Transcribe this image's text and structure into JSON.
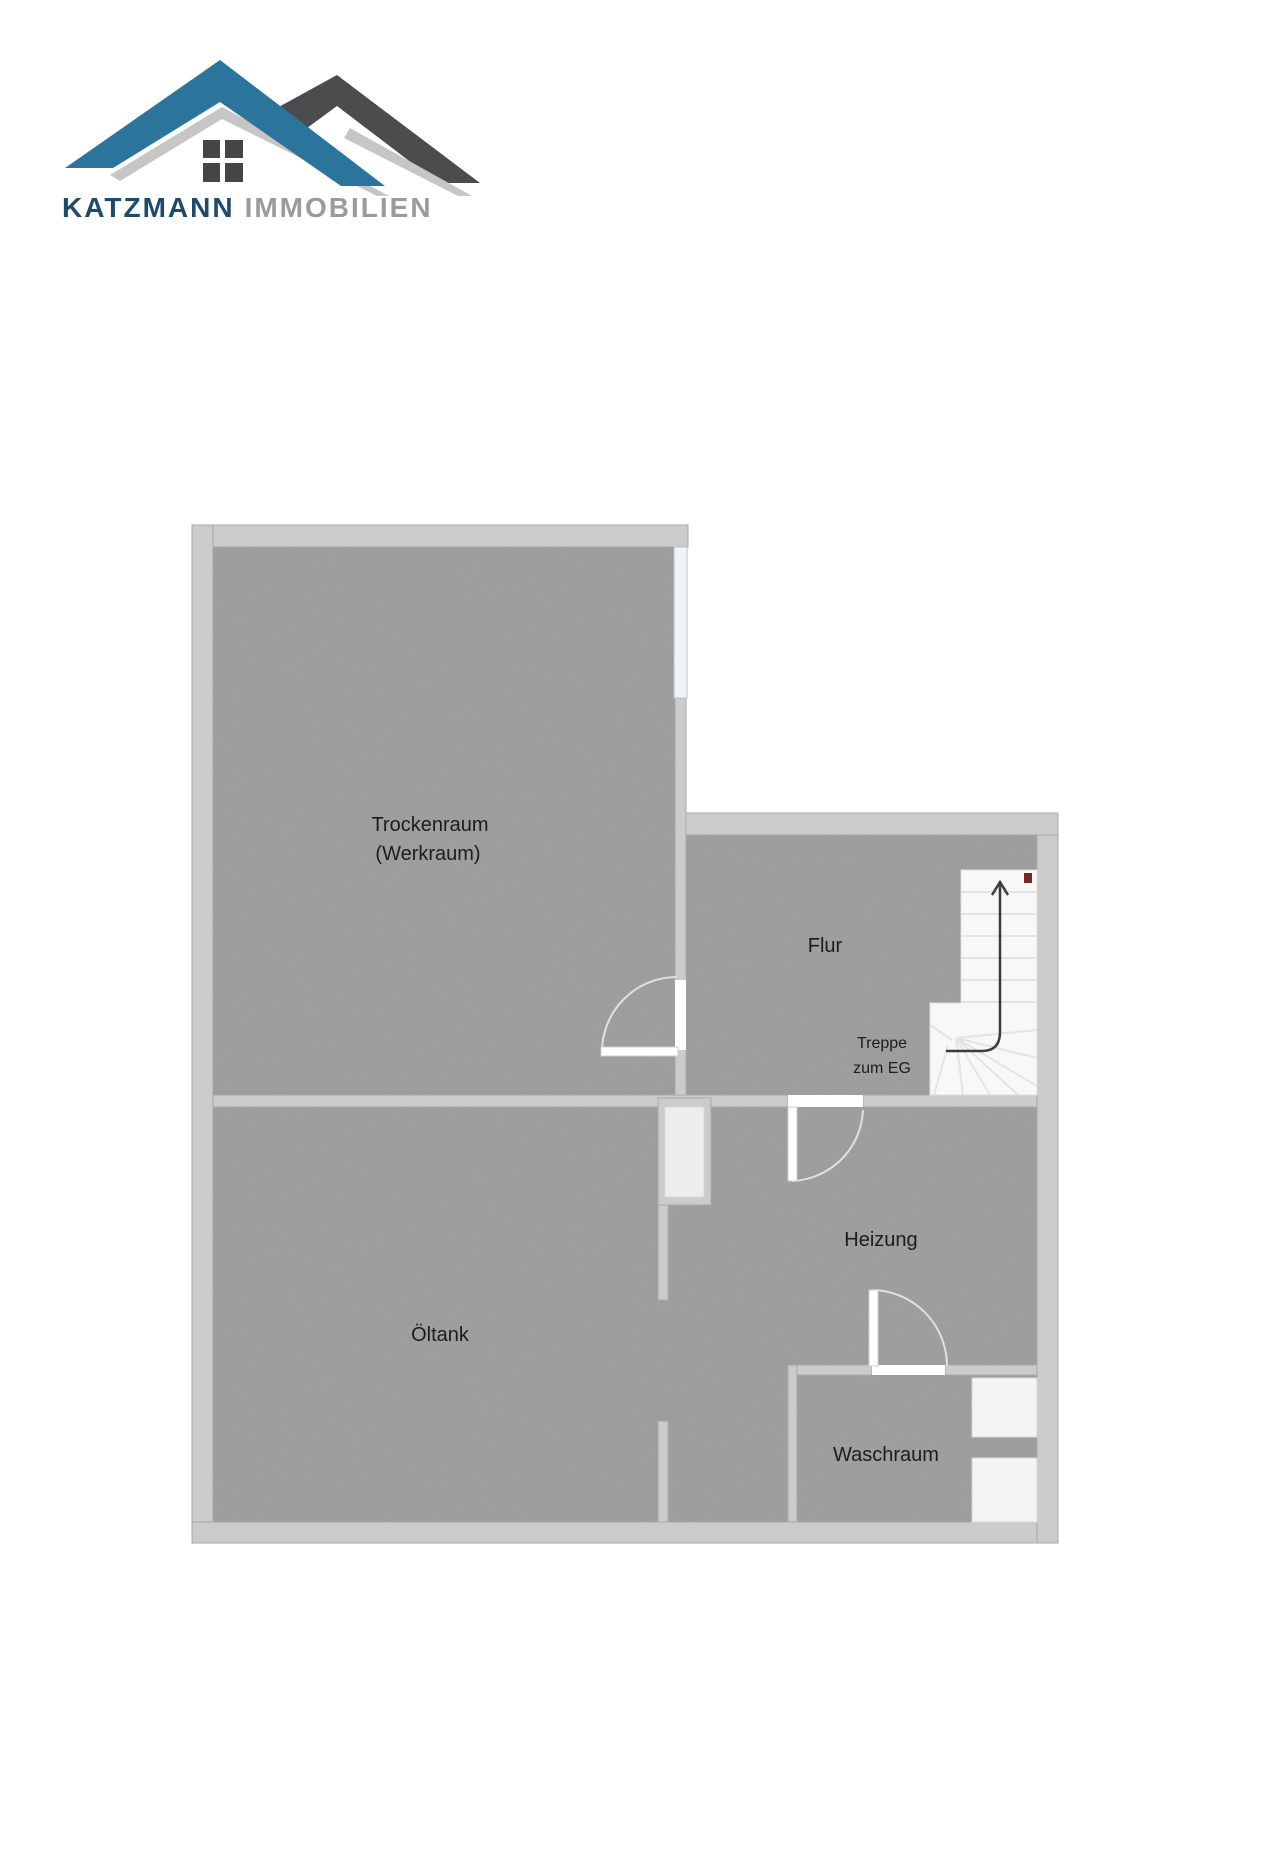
{
  "brand": {
    "name_primary": "KATZMANN",
    "name_secondary": "IMMOBILIEN",
    "logo_colors": {
      "roof_blue": "#2b749c",
      "roof_dark_gray": "#4c4c4f",
      "shadow_gray": "#c6c6c6",
      "window_pane": "#454547",
      "text_primary": "#1e4a6b",
      "text_secondary": "#9b9b9b"
    }
  },
  "floorplan": {
    "type": "basement-floor-plan",
    "rooms": [
      {
        "id": "trockenraum",
        "label": "Trockenraum",
        "sublabel": "(Werkraum)"
      },
      {
        "id": "flur",
        "label": "Flur"
      },
      {
        "id": "heizung",
        "label": "Heizung"
      },
      {
        "id": "oeltank",
        "label": "Öltank"
      },
      {
        "id": "waschraum",
        "label": "Waschraum"
      }
    ],
    "stairs": {
      "label_line1": "Treppe",
      "label_line2": "zum EG",
      "direction": "up"
    },
    "colors": {
      "floor": "#9b9b9b",
      "wall": "#cbcbcb",
      "stair_fill": "#f8f8f8",
      "arrow": "#3c3c3c",
      "stair_marker": "#7a2622",
      "label_text": "#1c1c1c"
    }
  }
}
